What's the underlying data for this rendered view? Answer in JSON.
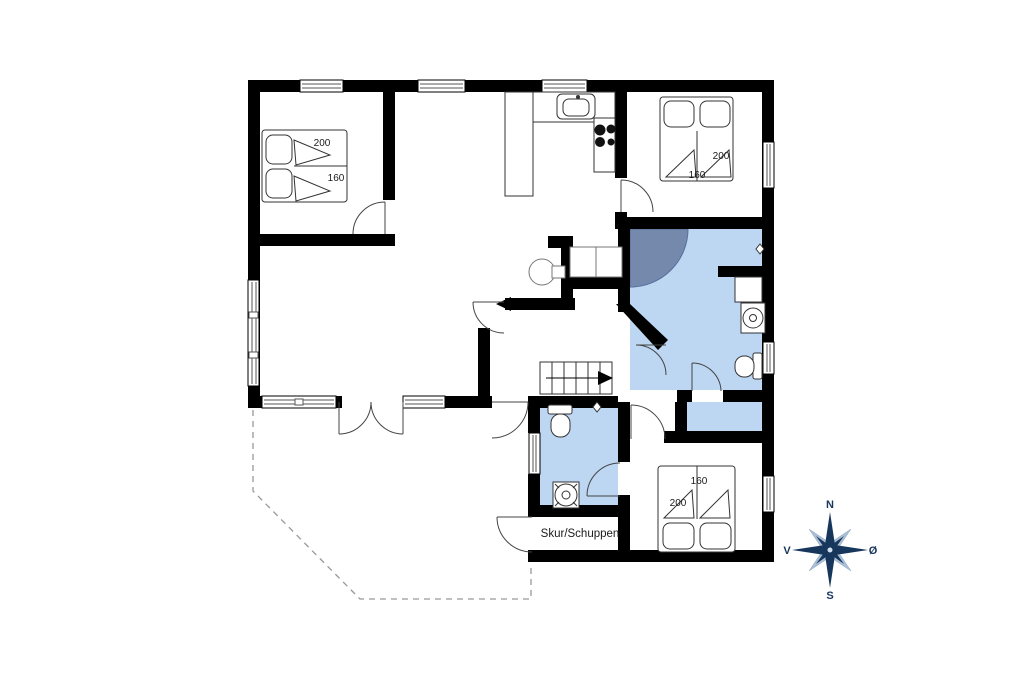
{
  "plan": {
    "shed": {
      "label": "Skur/Schuppen"
    },
    "compass": {
      "north": "N",
      "east": "Ø",
      "south": "S",
      "west": "V"
    },
    "bedrooms": [
      {
        "position": "top-left",
        "bed_length": "200",
        "bed_width": "160"
      },
      {
        "position": "top-right",
        "bed_length": "200",
        "bed_width": "160"
      },
      {
        "position": "bottom-right",
        "bed_length": "200",
        "bed_width": "160"
      }
    ],
    "colors": {
      "walls": "#000000",
      "bathroom_floor": "#bdd6f2",
      "door_swing_shaded": "#7589ac",
      "compass_primary": "#17365c",
      "compass_secondary": "#a9bfd6",
      "terrace_dashed": "#999999",
      "background": "#ffffff"
    }
  }
}
